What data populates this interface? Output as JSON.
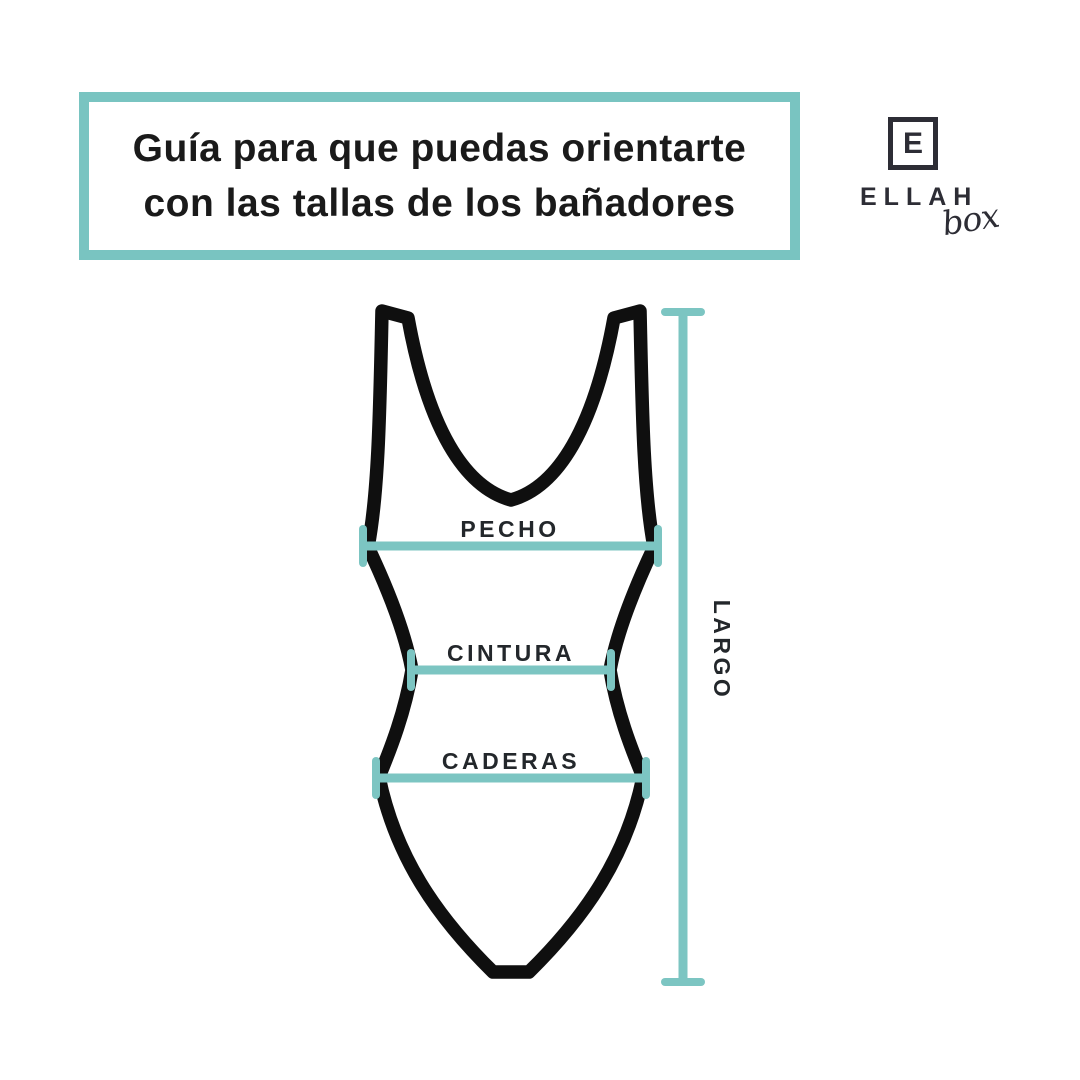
{
  "title": {
    "line1": "Guía para que puedas orientarte",
    "line2": "con las tallas de los bañadores"
  },
  "logo": {
    "monogram": "E",
    "name": "ELLAH",
    "suffix": "box"
  },
  "diagram": {
    "labels": {
      "chest": "PECHO",
      "waist": "CINTURA",
      "hips": "CADERAS",
      "length": "LARGO"
    }
  },
  "colors": {
    "accent_teal": "#79c4c1",
    "measure_teal": "#7cc5c2",
    "outline_black": "#0f0f0f",
    "title_text": "#1a1a1a",
    "logo_charcoal": "#2d2d35",
    "background": "#ffffff"
  }
}
